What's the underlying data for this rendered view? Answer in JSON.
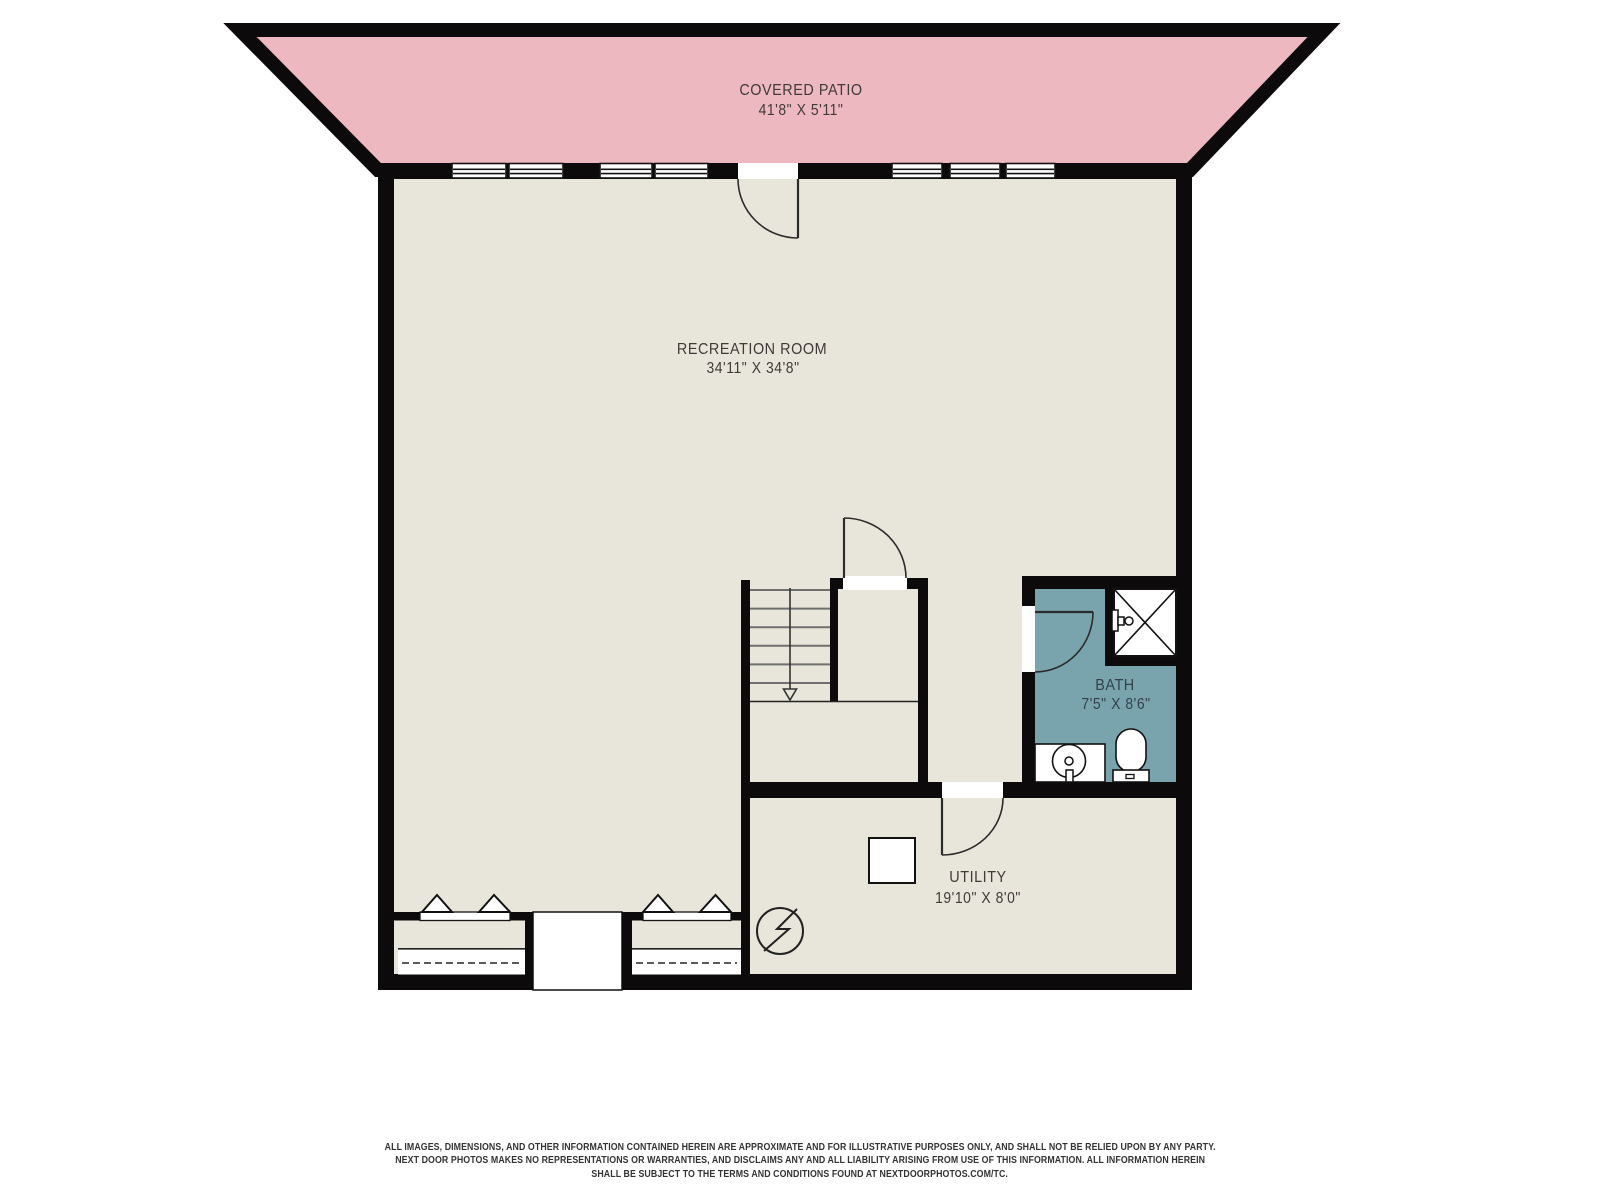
{
  "plan": {
    "colors": {
      "wall": "#0c0a0a",
      "floor": "#e8e6da",
      "patio": "#edb8bf",
      "bath": "#7aa4ad",
      "white": "#ffffff"
    },
    "rooms": [
      {
        "id": "covered-patio",
        "name": "COVERED PATIO",
        "dims": "41'8\" X 5'11\""
      },
      {
        "id": "recreation-room",
        "name": "RECREATION ROOM",
        "dims": "34'11\" X 34'8\""
      },
      {
        "id": "bath",
        "name": "BATH",
        "dims": "7'5\" X 8'6\""
      },
      {
        "id": "utility",
        "name": "UTILITY",
        "dims": "19'10\" X 8'0\""
      }
    ],
    "symbols": [
      "window-icon",
      "door-swing-icon",
      "stairs-down-icon",
      "bifold-door-icon",
      "closet-shelf-icon",
      "shower-icon",
      "sink-icon",
      "toilet-icon",
      "water-heater-icon",
      "electrical-meter-icon"
    ]
  },
  "footer": {
    "line1": "ALL IMAGES, DIMENSIONS, AND OTHER INFORMATION CONTAINED HEREIN ARE APPROXIMATE AND FOR ILLUSTRATIVE PURPOSES ONLY, AND SHALL NOT BE RELIED UPON BY ANY PARTY.",
    "line2": "NEXT DOOR PHOTOS MAKES NO REPRESENTATIONS OR WARRANTIES, AND DISCLAIMS ANY AND ALL LIABILITY ARISING FROM USE OF THIS INFORMATION. ALL INFORMATION HEREIN",
    "line3": "SHALL BE SUBJECT TO THE TERMS AND CONDITIONS FOUND AT NEXTDOORPHOTOS.COM/TC."
  }
}
